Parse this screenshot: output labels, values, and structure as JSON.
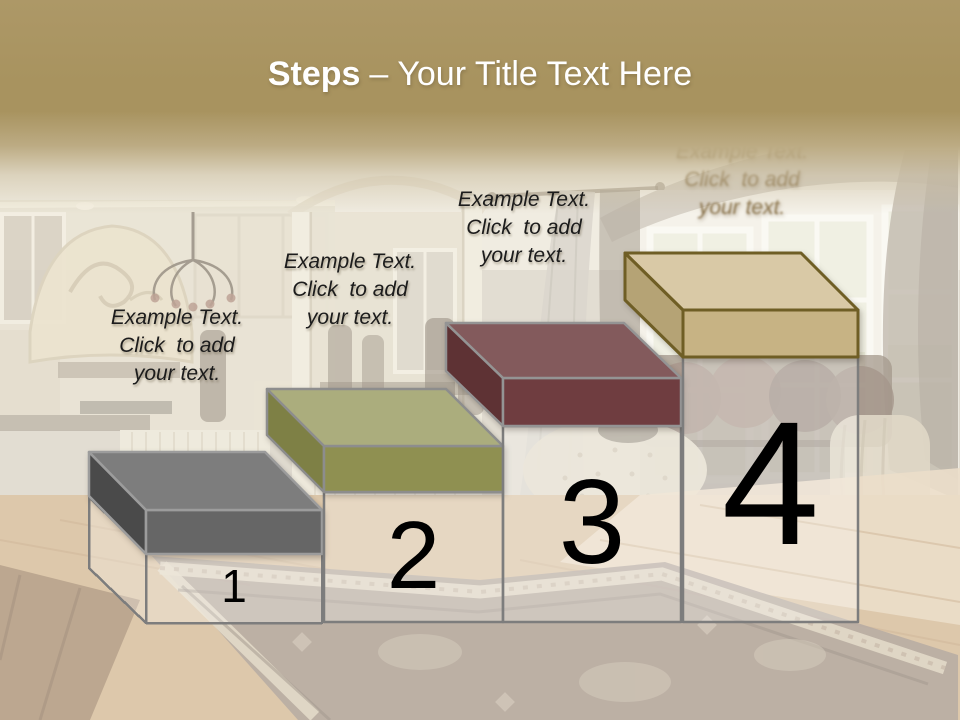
{
  "slide": {
    "title": {
      "bold": "Steps",
      "dash": "–",
      "rest": "Your Title Text Here",
      "text_color": "#ffffff"
    },
    "title_band_color": "#a8935f"
  },
  "pedestal": {
    "fill": "rgba(255,255,255,0.28)",
    "stroke": "#7d7d7d"
  },
  "steps": [
    {
      "number": "1",
      "label": "Example Text.\nClick  to add\nyour text.",
      "colors": {
        "top": "#7d7d7d",
        "front": "#666666",
        "side": "#4a4a4a",
        "stroke": "#9c9c9c"
      }
    },
    {
      "number": "2",
      "label": "Example Text.\nClick  to add\nyour text.",
      "colors": {
        "top": "#abad7d",
        "front": "#8f9051",
        "side": "#7e8045",
        "stroke": "#8d8d8d"
      }
    },
    {
      "number": "3",
      "label": "Example Text.\nClick  to add\nyour text.",
      "colors": {
        "top": "#835a5c",
        "front": "#6f3d40",
        "side": "#5e3234",
        "stroke": "#949494"
      }
    },
    {
      "number": "4",
      "label": "Example Text.\nClick  to add\nyour text.",
      "colors": {
        "top": "#d9c9a6",
        "front": "#c7b384",
        "side": "#b5a375",
        "stroke": "#6f5e25"
      }
    }
  ]
}
